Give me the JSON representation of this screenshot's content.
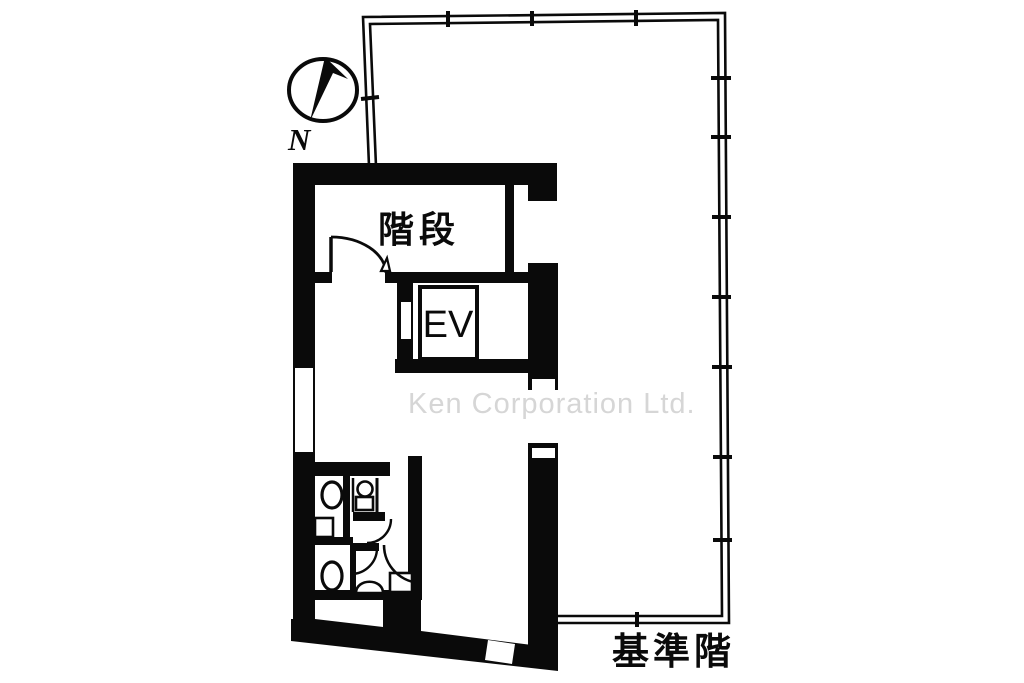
{
  "floor_plan": {
    "compass_label": "N",
    "stair_label": "階段",
    "elevator_label": "EV",
    "watermark": "Ken Corporation Ltd.",
    "caption": "基準階"
  },
  "colors": {
    "wall": "#000000",
    "background": "#ffffff",
    "watermark_gray": "#d6d6d6"
  }
}
